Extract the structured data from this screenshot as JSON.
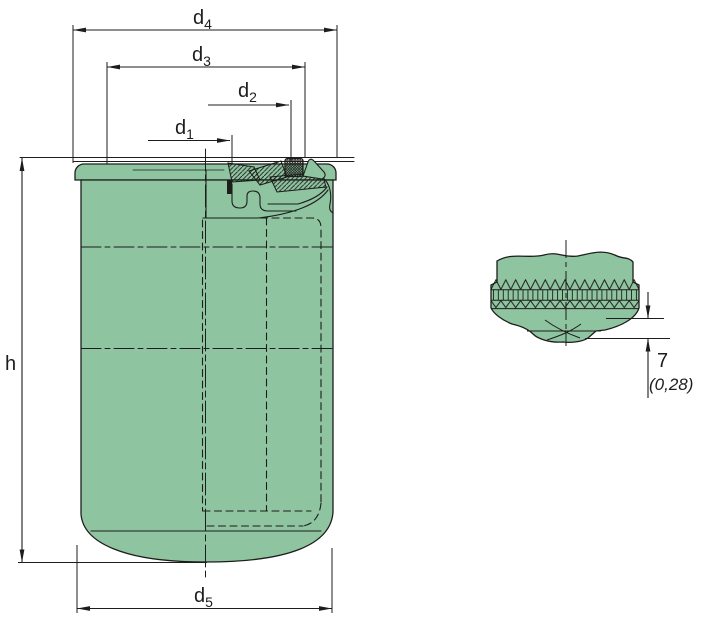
{
  "drawing": {
    "type": "spin-on filter technical drawing, side cross-section with bottom detail view",
    "colors": {
      "body_fill": "#8fc4a1",
      "line": "#1d1d1b",
      "background": "#ffffff"
    },
    "dimensions": {
      "d1": {
        "base": "d",
        "sub": "1"
      },
      "d2": {
        "base": "d",
        "sub": "2"
      },
      "d3": {
        "base": "d",
        "sub": "3"
      },
      "d4": {
        "base": "d",
        "sub": "4"
      },
      "d5": {
        "base": "d",
        "sub": "5"
      },
      "h": {
        "base": "h",
        "sub": ""
      }
    },
    "detail_dimension": {
      "value": "7",
      "secondary": "(0,28)"
    }
  }
}
